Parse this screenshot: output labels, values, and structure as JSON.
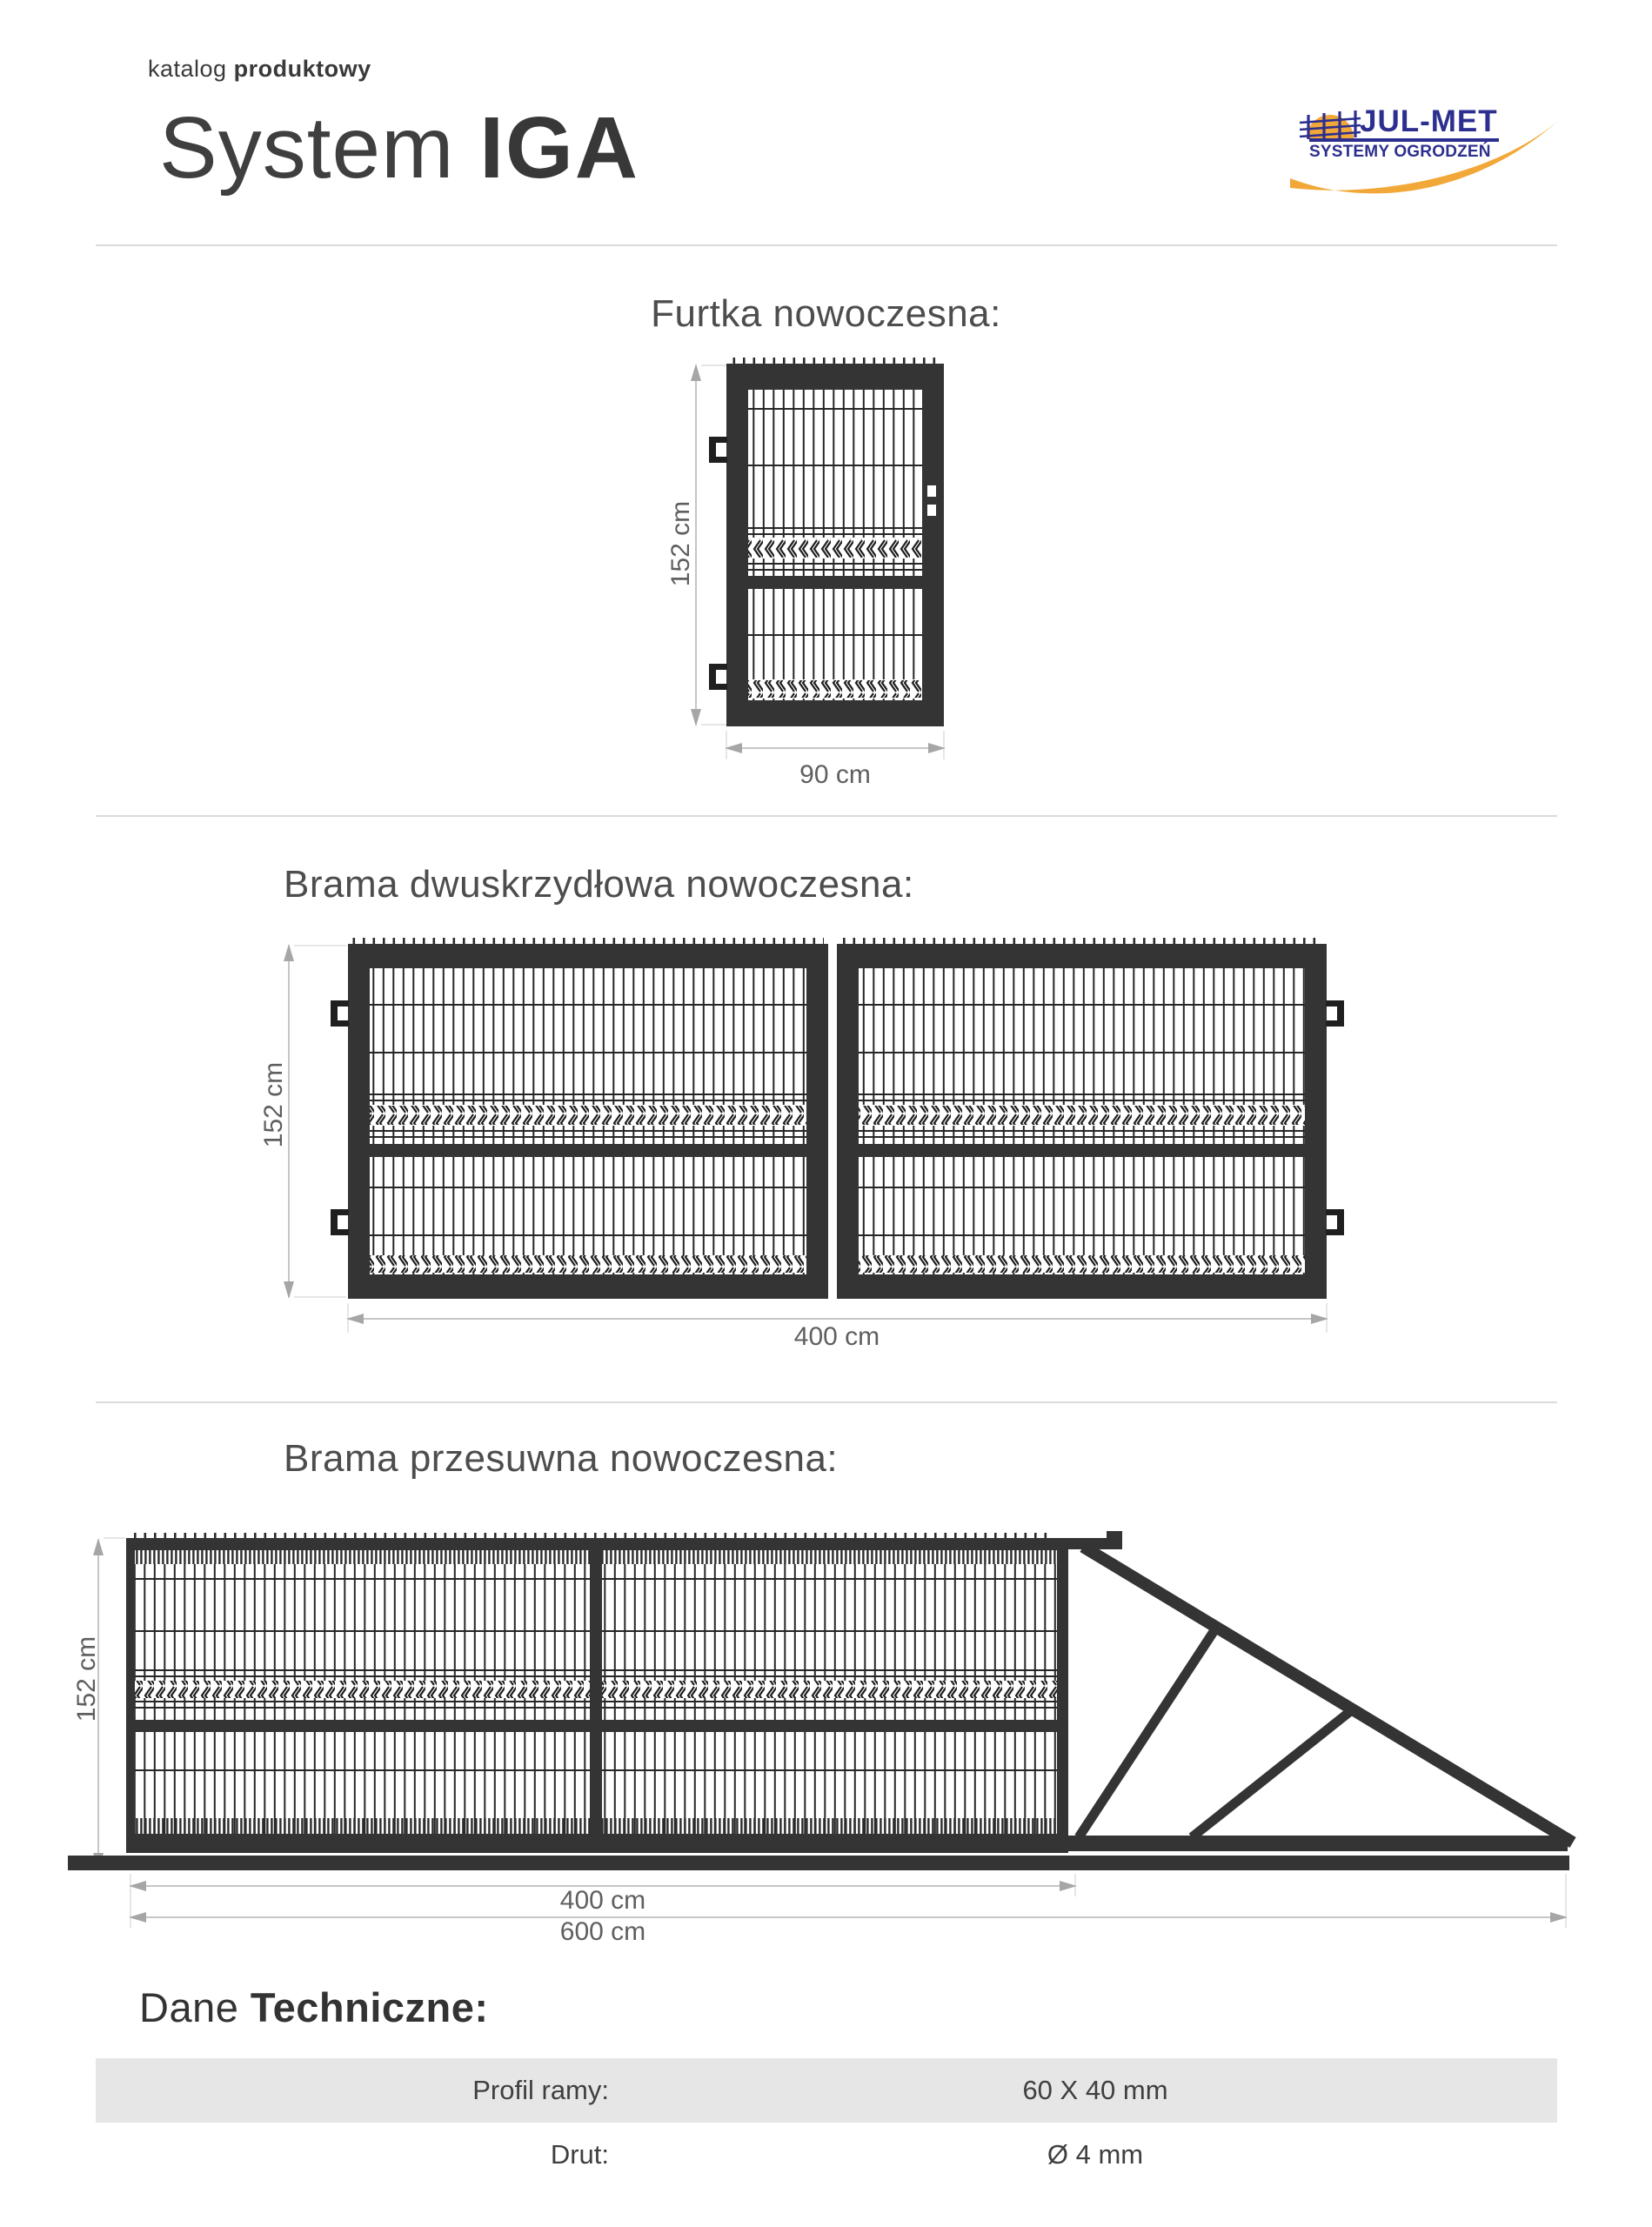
{
  "header": {
    "eyebrow_light": "katalog",
    "eyebrow_bold": "produktowy",
    "title_light": "System",
    "title_bold": "IGA"
  },
  "logo": {
    "name": "JUL-MET",
    "tagline": "SYSTEMY OGRODZEŃ",
    "colors": {
      "blue": "#2d2f8f",
      "orange": "#f2a838"
    }
  },
  "sections": {
    "furtka": {
      "title": "Furtka nowoczesna:",
      "height": "152 cm",
      "width": "90 cm"
    },
    "dwuskrzydlowa": {
      "title": "Brama dwuskrzydłowa nowoczesna:",
      "height": "152 cm",
      "width": "400 cm"
    },
    "przesuwna": {
      "title": "Brama przesuwna nowoczesna:",
      "height": "152 cm",
      "width_panel": "400 cm",
      "width_total": "600 cm"
    }
  },
  "specs": {
    "heading_light": "Dane",
    "heading_bold": "Techniczne:",
    "rows": [
      {
        "label": "Profil ramy:",
        "value": "60 X 40 mm"
      },
      {
        "label": "Drut:",
        "value": "Ø 4 mm"
      }
    ]
  }
}
